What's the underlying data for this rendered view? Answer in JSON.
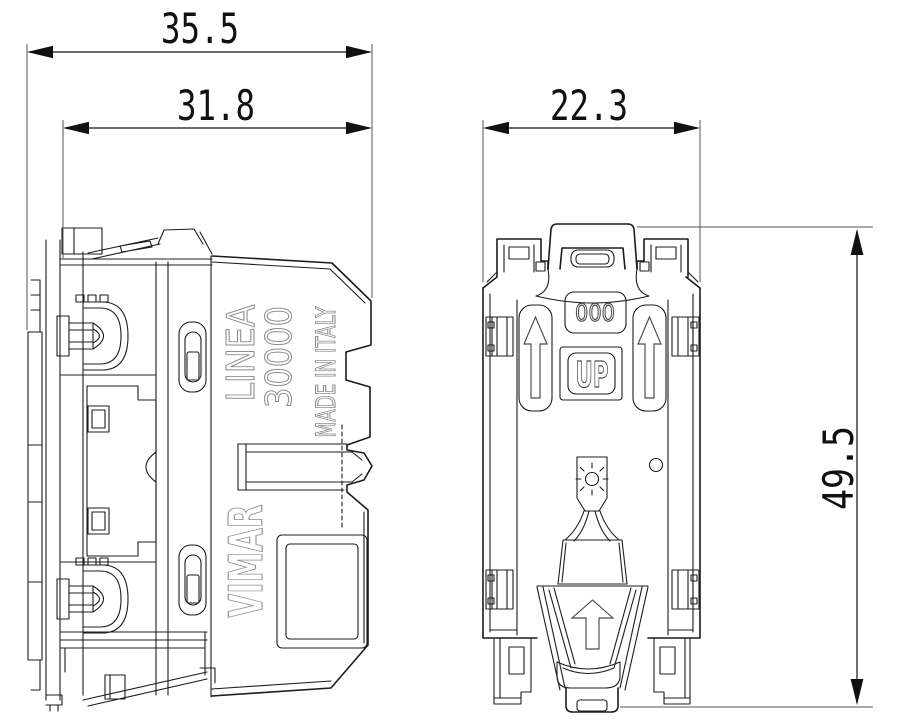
{
  "page": {
    "background": "#ffffff",
    "line_color": "#1c1c1c",
    "emboss_color": "#8f8f8f"
  },
  "views": {
    "side": {
      "markings": {
        "series": "LINEA",
        "model": "30000",
        "origin": "MADE IN ITALY",
        "brand": "VIMAR"
      }
    },
    "rear": {
      "markings": {
        "code": "000",
        "up_label": "UP"
      },
      "icons": [
        "up-arrow-icon",
        "lamp-icon",
        "clip-arrow-icon",
        "pilot-hole"
      ]
    }
  },
  "dimensions": {
    "overall_width": "35.5",
    "inner_width": "31.8",
    "module_width": "22.3",
    "height": "49.5"
  }
}
